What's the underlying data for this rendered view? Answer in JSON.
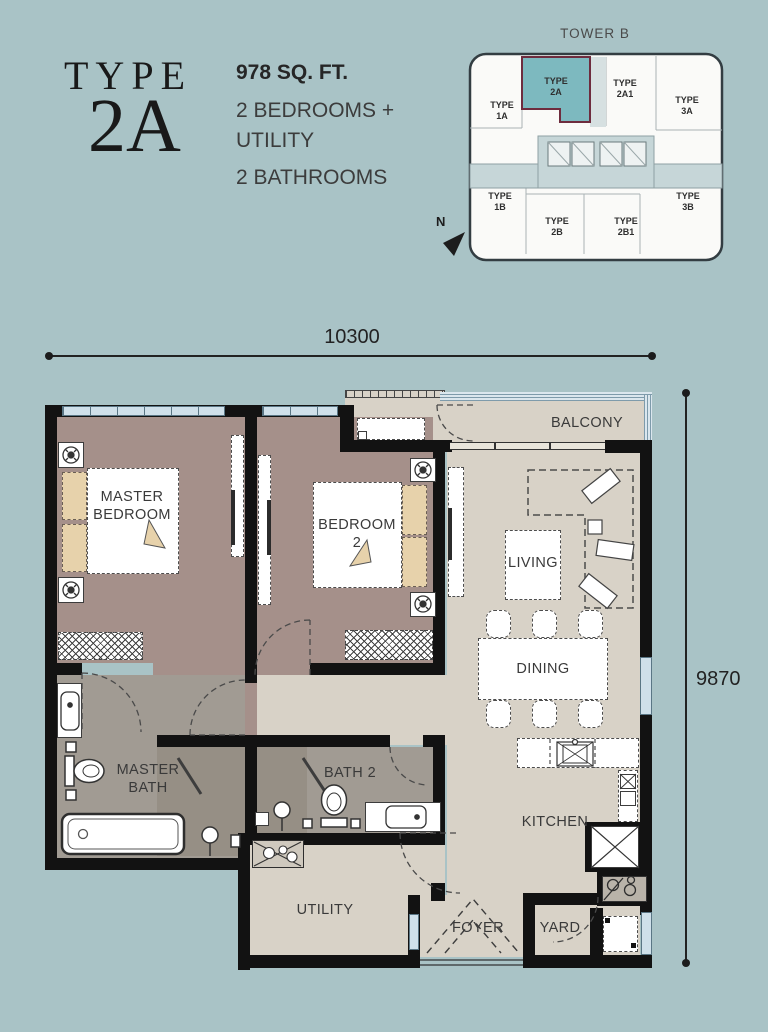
{
  "colors": {
    "background": "#a9c3c6",
    "floor_light": "#d8d2c7",
    "floor_bedroom": "#a5908a",
    "floor_bath": "#a19b93",
    "floor_shower": "#968f85",
    "wall": "#121212",
    "pillow": "#e7d2ab",
    "glass": "#cfe0ea",
    "unit_highlight": "#7db9bf",
    "unit_highlight_border": "#6e2c3e"
  },
  "title": {
    "prefix": "TYPE",
    "code": "2A"
  },
  "specs": {
    "area": "978 SQ. FT.",
    "bedrooms": "2 BEDROOMS +\nUTILITY",
    "bathrooms": "2 BATHROOMS"
  },
  "tower": {
    "title": "TOWER B",
    "north": "N",
    "units": [
      {
        "label": "TYPE\n1A"
      },
      {
        "label": "TYPE\n2A"
      },
      {
        "label": "TYPE\n2A1"
      },
      {
        "label": "TYPE\n3A"
      },
      {
        "label": "TYPE\n1B"
      },
      {
        "label": "TYPE\n2B"
      },
      {
        "label": "TYPE\n2B1"
      },
      {
        "label": "TYPE\n3B"
      }
    ]
  },
  "dimensions": {
    "width": "10300",
    "height": "9870"
  },
  "rooms": {
    "master_bedroom": "MASTER\nBEDROOM",
    "bedroom2": "BEDROOM\n2",
    "living": "LIVING",
    "dining": "DINING",
    "kitchen": "KITCHEN",
    "balcony": "BALCONY",
    "master_bath": "MASTER\nBATH",
    "bath2": "BATH 2",
    "utility": "UTILITY",
    "foyer": "FOYER",
    "yard": "YARD"
  }
}
